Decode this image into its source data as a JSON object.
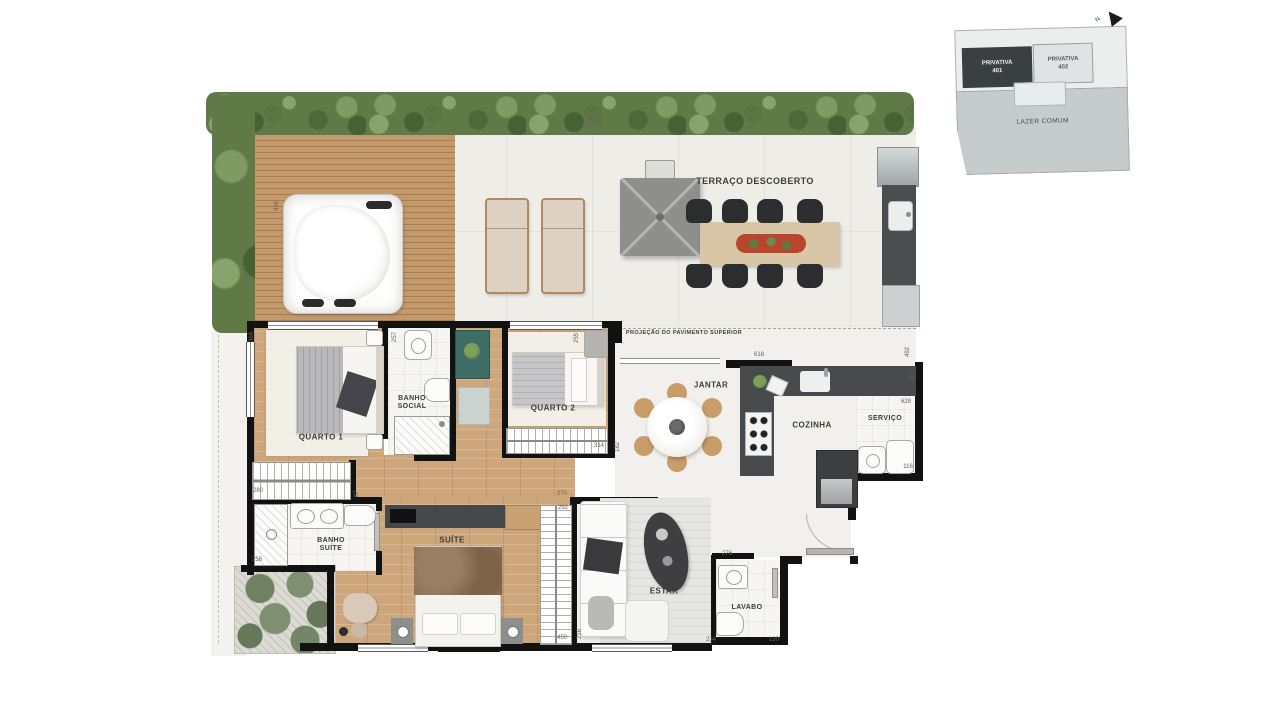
{
  "key_plan": {
    "north": "N",
    "unit_401_line1": "PRIVATIVA",
    "unit_401_line2": "401",
    "unit_402_line1": "PRIVATIVA",
    "unit_402_line2": "402",
    "common_label": "LAZER COMUM"
  },
  "labels": [
    {
      "text": "TERRAÇO DESCOBERTO",
      "x": 755,
      "y": 181,
      "size": 9
    },
    {
      "text": "PROJEÇÃO DO PAVIMENTO SUPERIOR",
      "x": 684,
      "y": 333,
      "size": 5.5
    },
    {
      "text": "QUARTO 1",
      "x": 321,
      "y": 437,
      "size": 8
    },
    {
      "text": "BANHO\nSOCIAL",
      "x": 412,
      "y": 403,
      "size": 7
    },
    {
      "text": "QUARTO 2",
      "x": 553,
      "y": 408,
      "size": 8
    },
    {
      "text": "JANTAR",
      "x": 711,
      "y": 385,
      "size": 8
    },
    {
      "text": "COZINHA",
      "x": 812,
      "y": 425,
      "size": 8
    },
    {
      "text": "SERVIÇO",
      "x": 885,
      "y": 419,
      "size": 7
    },
    {
      "text": "BANHO\nSUÍTE",
      "x": 331,
      "y": 545,
      "size": 7
    },
    {
      "text": "SUÍTE",
      "x": 452,
      "y": 540,
      "size": 8
    },
    {
      "text": "ESTAR",
      "x": 664,
      "y": 591,
      "size": 8
    },
    {
      "text": "LAVABO",
      "x": 747,
      "y": 608,
      "size": 7
    }
  ],
  "dims": [
    {
      "text": "1336.5",
      "x": 592,
      "y": 126,
      "rot": 0
    },
    {
      "text": "416",
      "x": 277,
      "y": 206,
      "rot": 90
    },
    {
      "text": "368",
      "x": 252,
      "y": 337,
      "rot": 90
    },
    {
      "text": "257",
      "x": 395,
      "y": 337,
      "rot": 90
    },
    {
      "text": "255",
      "x": 577,
      "y": 338,
      "rot": 90
    },
    {
      "text": "314",
      "x": 599,
      "y": 446,
      "rot": 0
    },
    {
      "text": "182",
      "x": 618,
      "y": 447,
      "rot": 90
    },
    {
      "text": "618",
      "x": 759,
      "y": 355,
      "rot": 0
    },
    {
      "text": "492",
      "x": 908,
      "y": 352,
      "rot": 90
    },
    {
      "text": "211",
      "x": 913,
      "y": 377,
      "rot": 90
    },
    {
      "text": "628",
      "x": 906,
      "y": 402,
      "rot": 0
    },
    {
      "text": "116",
      "x": 908,
      "y": 467,
      "rot": 0
    },
    {
      "text": "280",
      "x": 258,
      "y": 491,
      "rot": 0
    },
    {
      "text": "87",
      "x": 357,
      "y": 494,
      "rot": 90
    },
    {
      "text": "258",
      "x": 257,
      "y": 560,
      "rot": 0
    },
    {
      "text": "270",
      "x": 562,
      "y": 494,
      "rot": 0
    },
    {
      "text": "292",
      "x": 563,
      "y": 508,
      "rot": 0
    },
    {
      "text": "216",
      "x": 580,
      "y": 634,
      "rot": 90
    },
    {
      "text": "450",
      "x": 562,
      "y": 638,
      "rot": 0
    },
    {
      "text": "276",
      "x": 727,
      "y": 554,
      "rot": 0
    },
    {
      "text": "234",
      "x": 711,
      "y": 640,
      "rot": 0
    },
    {
      "text": "120",
      "x": 774,
      "y": 640,
      "rot": 0
    }
  ]
}
